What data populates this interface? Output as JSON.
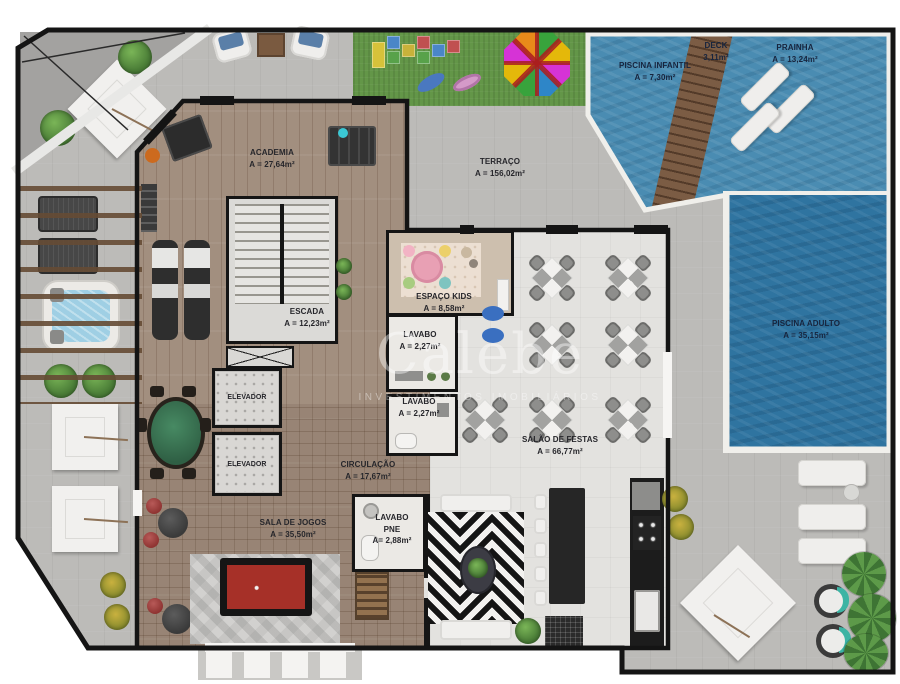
{
  "watermark": {
    "brand": "Calebe",
    "subtitle": "INVESTIMENTOS IMOBILIÁRIOS"
  },
  "rooms": {
    "academia": {
      "label": "ACADEMIA",
      "area": "A = 27,64m²"
    },
    "terraco": {
      "label": "TERRAÇO",
      "area": "A = 156,02m²"
    },
    "escada": {
      "label": "ESCADA",
      "area": "A = 12,23m²"
    },
    "elevador_1": {
      "label": "ELEVADOR"
    },
    "elevador_2": {
      "label": "ELEVADOR"
    },
    "espaco_kids": {
      "label": "ESPAÇO KIDS",
      "area": "A = 8,58m²"
    },
    "lavabo_1": {
      "label": "LAVABO",
      "area": "A = 2,27m²"
    },
    "lavabo_2": {
      "label": "LAVABO",
      "area": "A = 2,27m²"
    },
    "circulacao": {
      "label": "CIRCULAÇÃO",
      "area": "A = 17,67m²"
    },
    "sala_de_jogos": {
      "label": "SALA DE JOGOS",
      "area": "A = 35,50m²"
    },
    "lavabo_pne": {
      "label": "LAVABO",
      "label2": "PNE",
      "area": "A= 2,88m²"
    },
    "salao_de_festas": {
      "label": "SALÃO DE FESTAS",
      "area": "A = 66,77m²"
    },
    "piscina_infantil": {
      "label": "PISCINA INFANTIL",
      "area": "A = 7,30m²"
    },
    "deck": {
      "label": "DECK",
      "area": "3,11m²"
    },
    "prainha": {
      "label": "PRAINHA",
      "area": "A = 13,24m²"
    },
    "piscina_adulto": {
      "label": "PISCINA ADULTO",
      "area": "A = 35,15m²"
    }
  },
  "colors": {
    "terrace": "#bcbbb8",
    "wood": "#a28f7f",
    "lawn": "#639648",
    "water_kids": "#4a8cb2",
    "water_adult": "#2f74a0",
    "deck_wood": "#7b5c44",
    "wall": "#151515",
    "room_label": "#26262b",
    "pool_label": "#17243d",
    "watermark": "rgba(255,255,255,0.42)",
    "pool_table_felt": "#a63028",
    "poker_felt": "#3f7d5a"
  }
}
